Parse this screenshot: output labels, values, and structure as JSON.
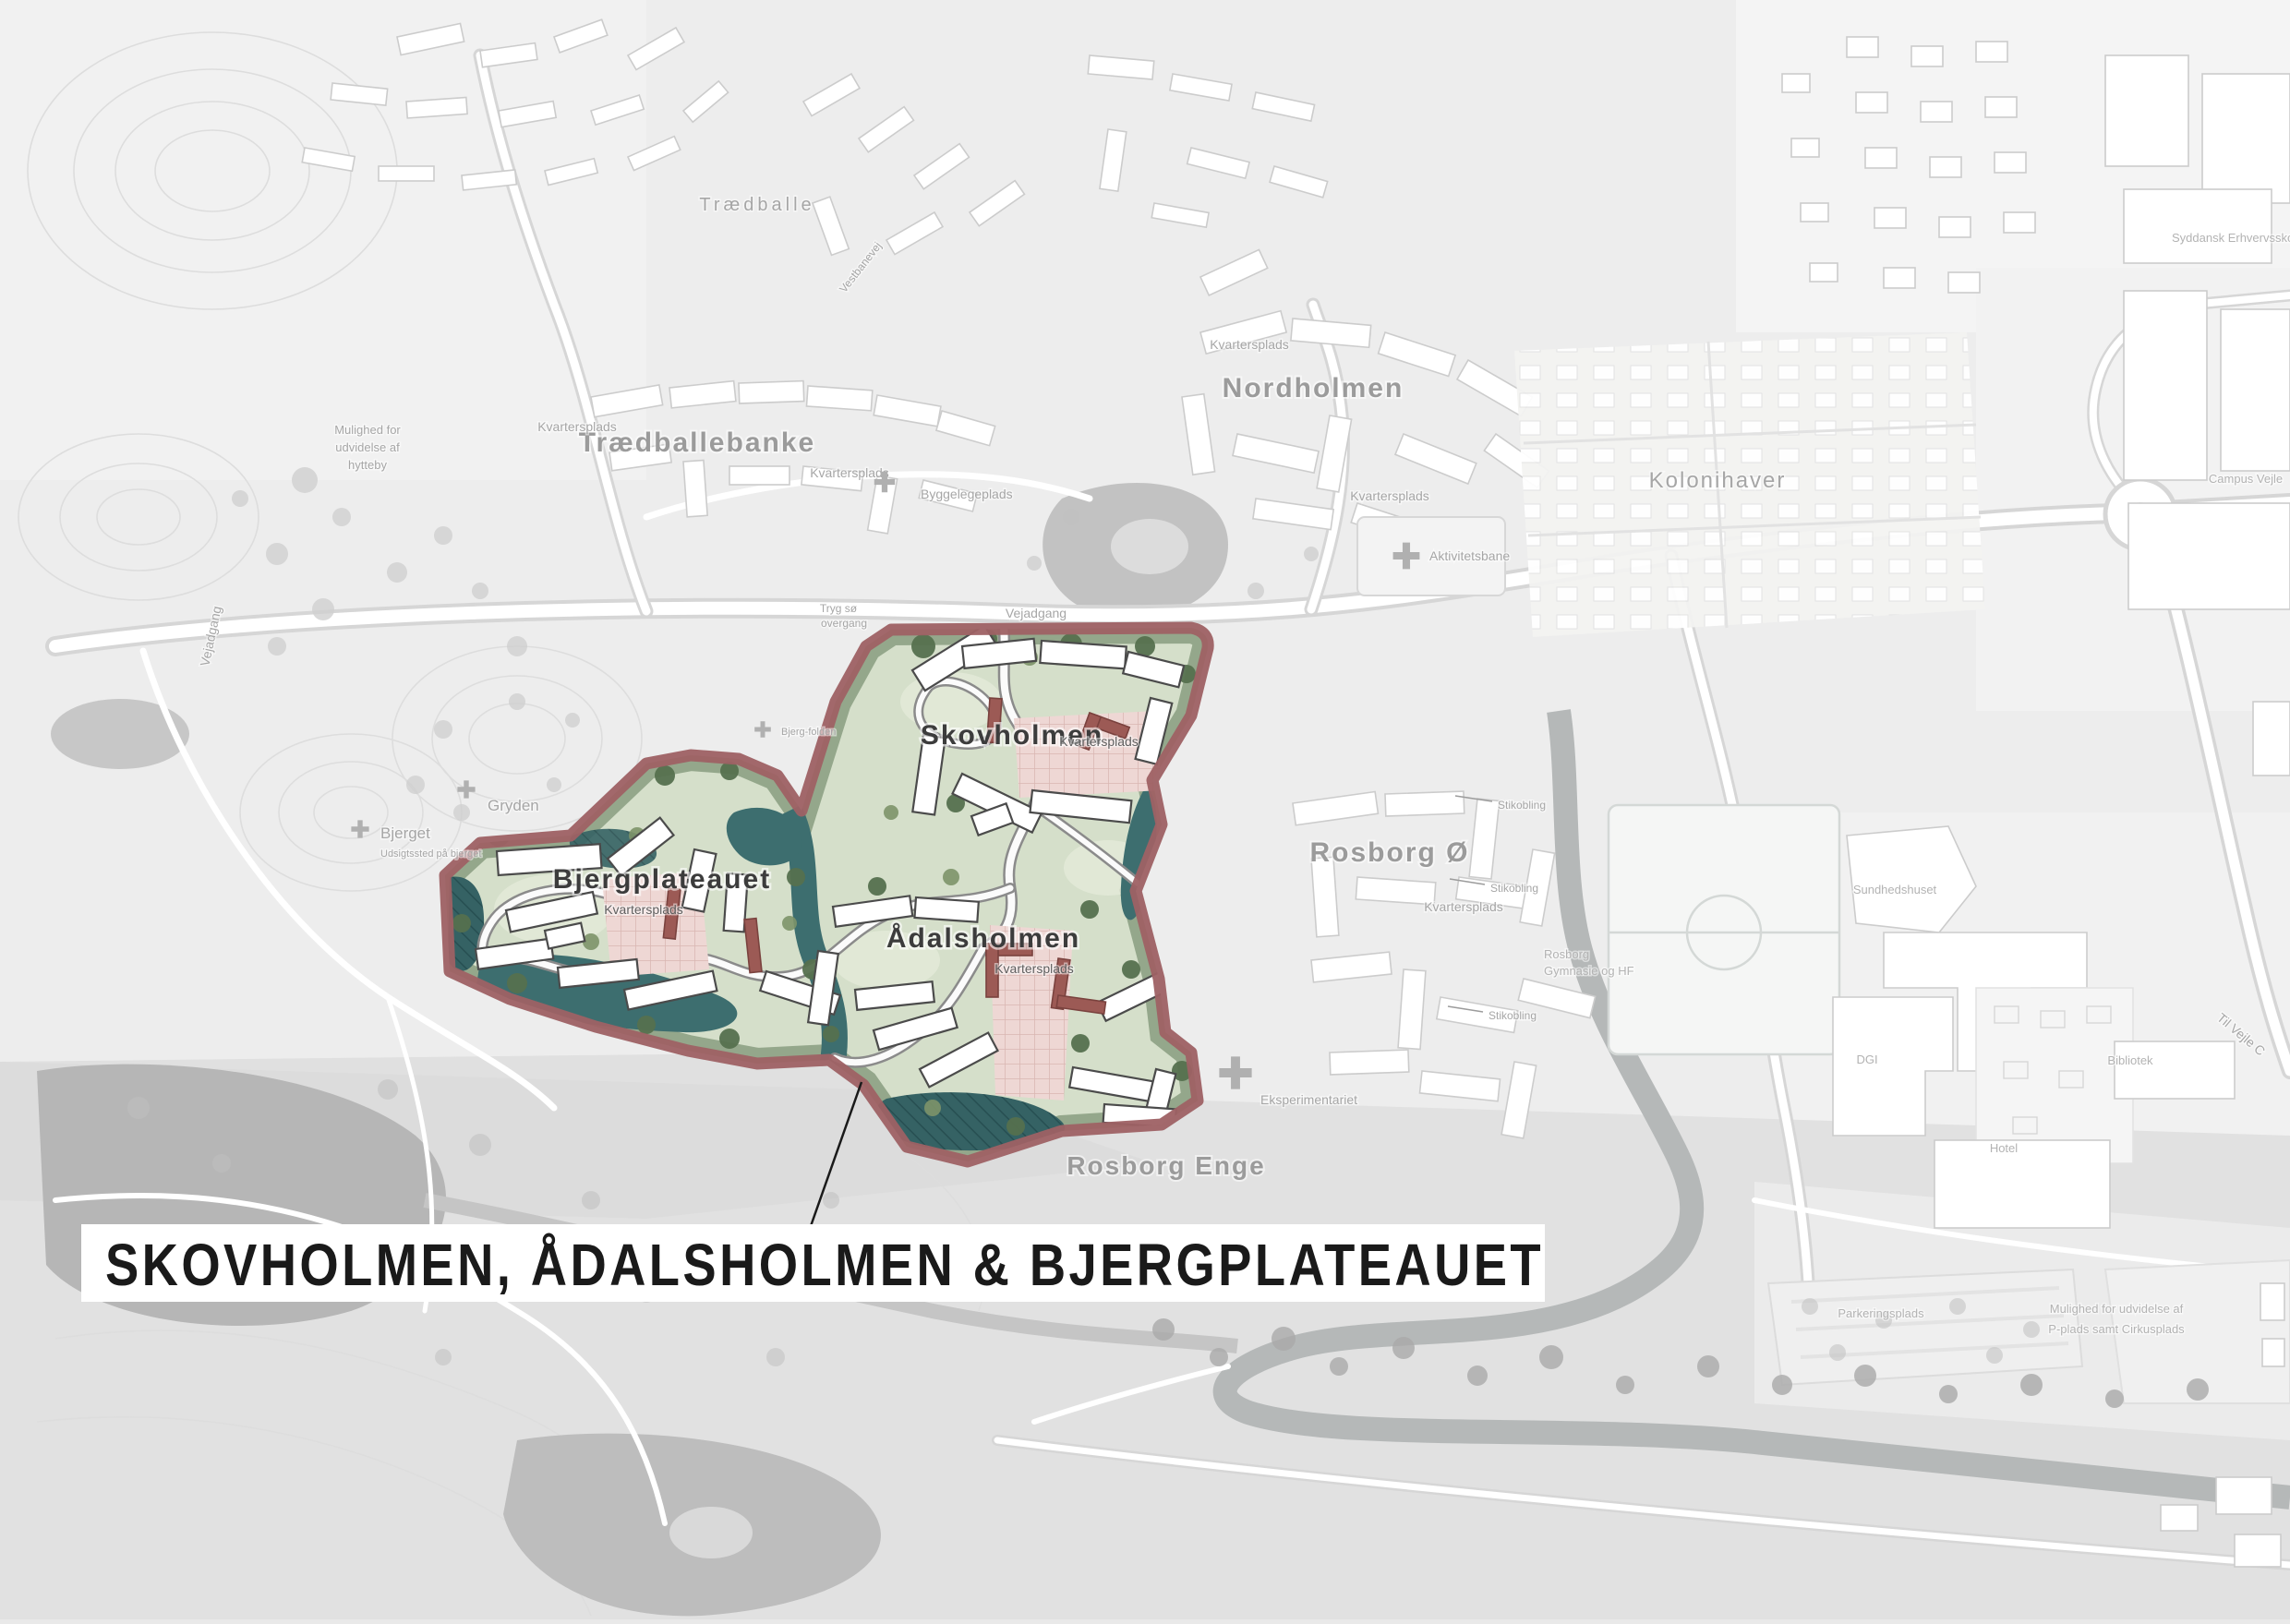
{
  "title": "SKOVHOLMEN, ÅDALSHOLMEN & BJERGPLATEAUET",
  "labels": {
    "traedballe": "Trædballe",
    "traedballebanke": "Trædballebanke",
    "nordholmen": "Nordholmen",
    "kolonihaver": "Kolonihaver",
    "skovholmen": "Skovholmen",
    "bjergplateauet": "Bjergplateauet",
    "aadalsholmen": "Ådalsholmen",
    "rosborg_o": "Rosborg Ø",
    "rosborg_enge": "Rosborg Enge",
    "gryden": "Gryden",
    "bjerget": "Bjerget",
    "bjerget_sub": "Udsigtssted på bjerget",
    "bjerg_folden": "Bjerg-folden",
    "kvartersplads": "Kvartersplads",
    "byggelegeplads": "Byggelegeplads",
    "aktivitetsbane": "Aktivitetsbane",
    "vejadgang": "Vejadgang",
    "tryg_so": "Tryg sø",
    "overgang": "overgang",
    "vestbanevej": "Vestbanevej",
    "syddansk": "Syddansk Erhvervsskole",
    "campus_vejle": "Campus Vejle",
    "sundhedshuset": "Sundhedshuset",
    "dgi": "DGI",
    "bibliotek": "Bibliotek",
    "hotel": "Hotel",
    "rosborg_gym_1": "Rosborg",
    "rosborg_gym_2": "Gymnasie og HF",
    "stikobling": "Stikobling",
    "eksperimentariet": "Eksperimentariet",
    "parkeringsplads": "Parkeringsplads",
    "mulighed_p_1": "Mulighed for udvidelse af",
    "mulighed_p_2": "P-plads samt Cirkusplads",
    "mulighed_h_1": "Mulighed for",
    "mulighed_h_2": "udvidelse af",
    "mulighed_h_3": "hytteby",
    "til_vejle": "Til Vejle C"
  },
  "colors": {
    "boundary": "#9e6164",
    "water_teal": "#3d6e6f",
    "accent_building": "#9c5a55",
    "plaza_pink": "#eed7d4",
    "title_text": "#1a1a1a",
    "title_box": "#ffffff"
  }
}
